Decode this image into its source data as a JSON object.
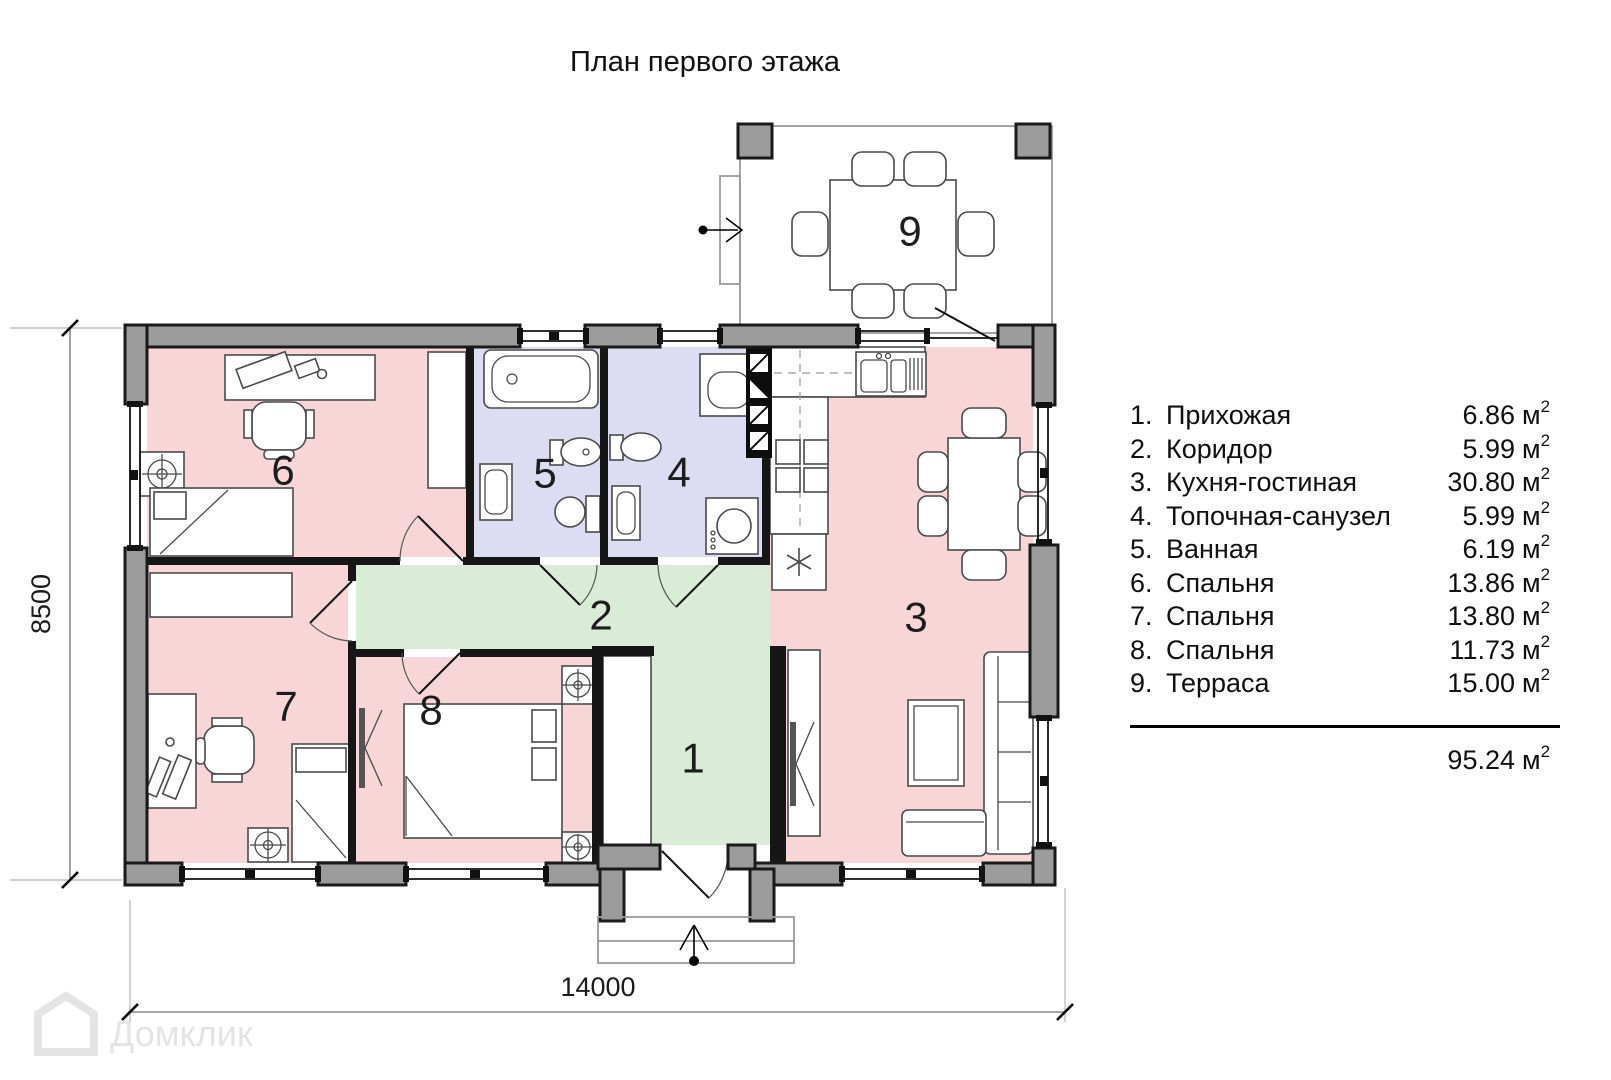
{
  "title": "План первого этажа",
  "legend": {
    "rooms": [
      {
        "num": "1.",
        "name": "Прихожая",
        "area": "6.86"
      },
      {
        "num": "2.",
        "name": "Коридор",
        "area": "5.99"
      },
      {
        "num": "3.",
        "name": "Кухня-гостиная",
        "area": "30.80"
      },
      {
        "num": "4.",
        "name": "Топочная-санузел",
        "area": "5.99"
      },
      {
        "num": "5.",
        "name": "Ванная",
        "area": "6.19"
      },
      {
        "num": "6.",
        "name": "Спальня",
        "area": "13.86"
      },
      {
        "num": "7.",
        "name": "Спальня",
        "area": "13.80"
      },
      {
        "num": "8.",
        "name": "Спальня",
        "area": "11.73"
      },
      {
        "num": "9.",
        "name": "Терраса",
        "area": "15.00"
      }
    ],
    "unit": "м",
    "sup": "2",
    "total": "95.24"
  },
  "plan": {
    "room_numbers": [
      "1",
      "2",
      "3",
      "4",
      "5",
      "6",
      "7",
      "8",
      "9"
    ],
    "dim_width": "14000",
    "dim_height": "8500"
  },
  "watermark": {
    "text": "Домклик"
  },
  "colors": {
    "room_pink": "#f8d6d8",
    "room_lavender": "#dcdcf2",
    "room_green": "#d9ecd5",
    "wall_gray": "#9c9c9c",
    "internal_wall": "#161616",
    "terrace_column": "#ababab"
  }
}
